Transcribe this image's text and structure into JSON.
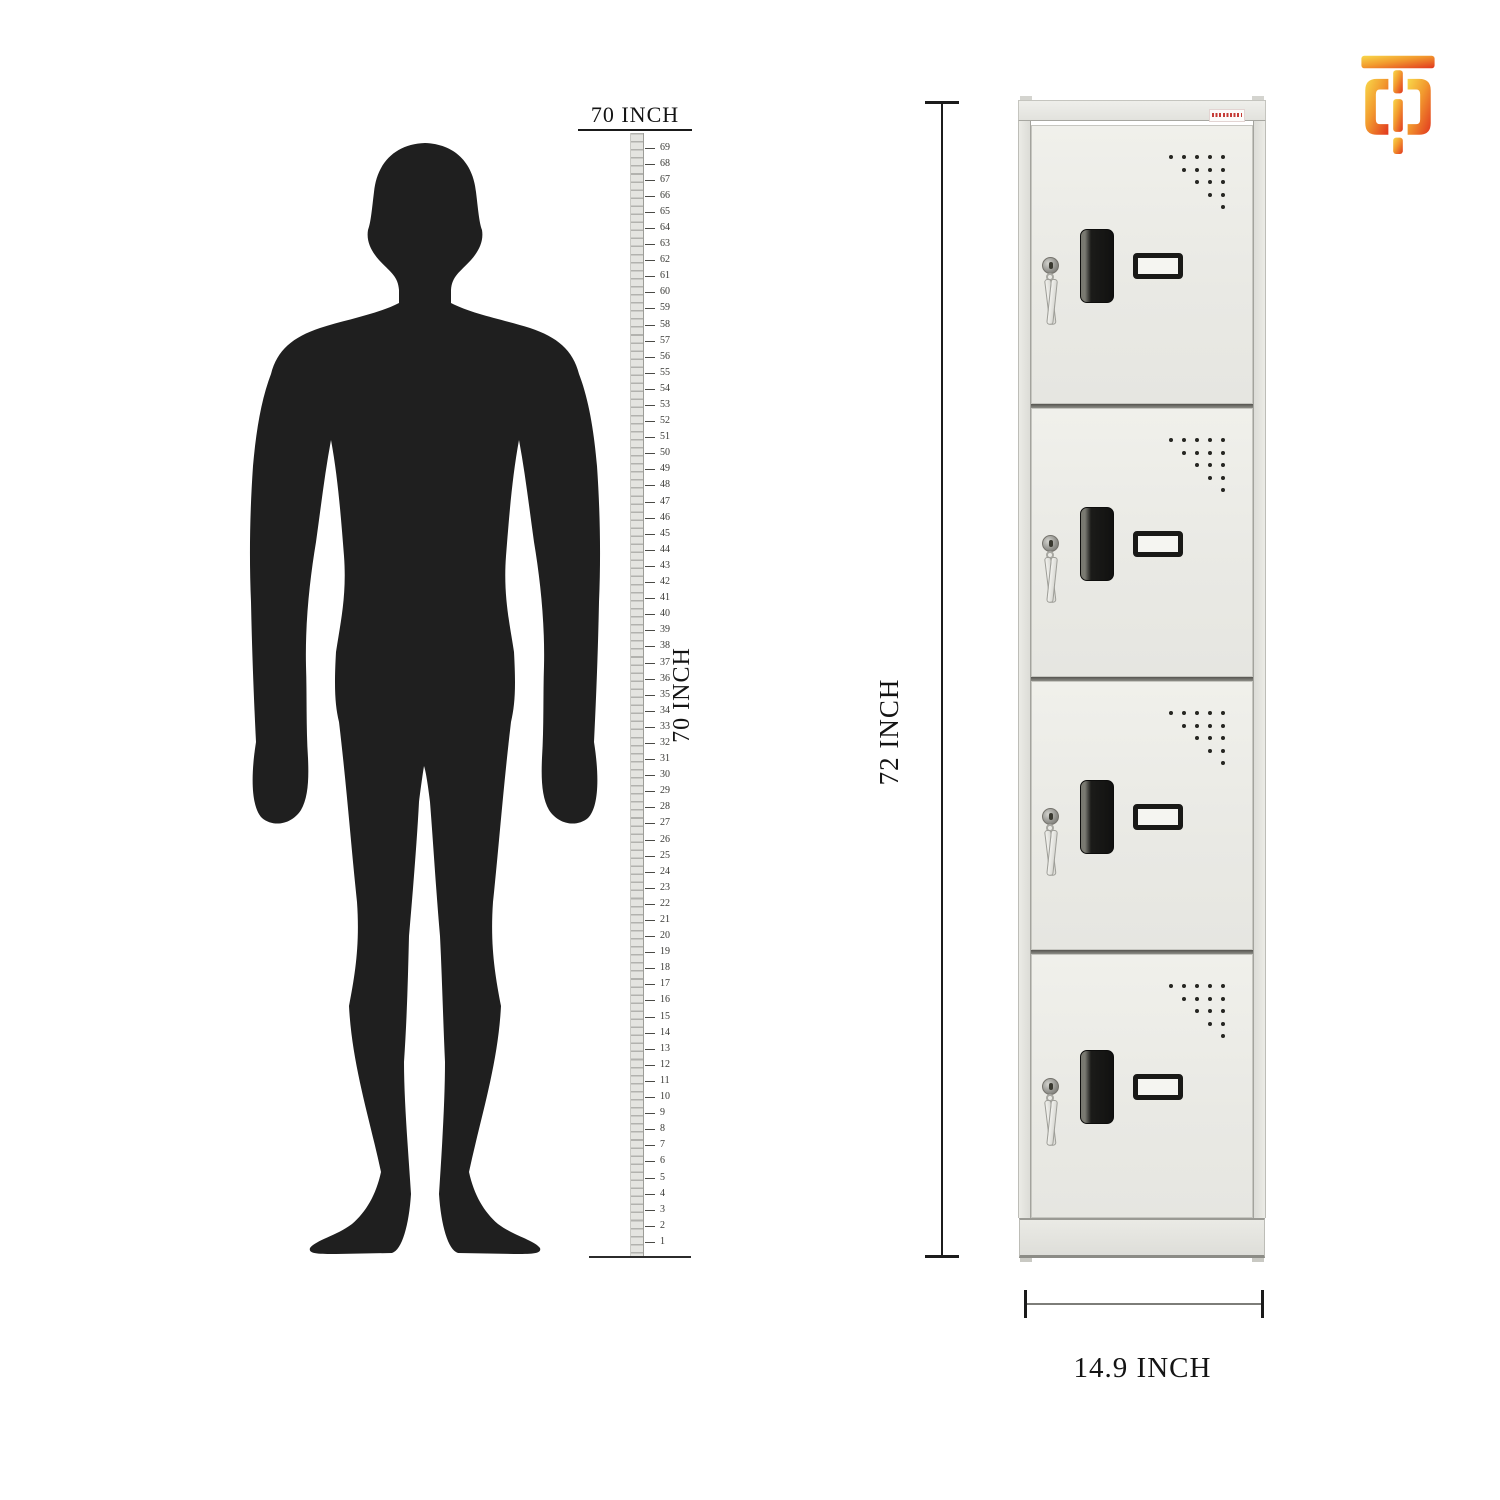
{
  "brand_logo": {
    "name": "orange TD monogram logo",
    "gradient_start": "#F8D84A",
    "gradient_mid": "#F29A2E",
    "gradient_end": "#E1371F"
  },
  "silhouette": {
    "description": "standing man silhouette",
    "color": "#1f1f1f"
  },
  "height_scale": {
    "top_label": "70 INCH",
    "side_label": "70 INCH",
    "tick_labels": [
      69,
      68,
      67,
      66,
      65,
      64,
      63,
      62,
      61,
      60,
      59,
      58,
      57,
      56,
      55,
      54,
      53,
      52,
      51,
      50,
      49,
      48,
      47,
      46,
      45,
      44,
      43,
      42,
      41,
      40,
      39,
      38,
      37,
      36,
      35,
      34,
      33,
      32,
      31,
      30,
      29,
      28,
      27,
      26,
      25,
      24,
      23,
      22,
      21,
      20,
      19,
      18,
      17,
      16,
      15,
      14,
      13,
      12,
      11,
      10,
      9,
      8,
      7,
      6,
      5,
      4,
      3,
      2,
      1
    ]
  },
  "locker": {
    "door_count": 4,
    "height_label": "72 INCH",
    "width_label": "14.9 INCH",
    "body_color": "#e8e8e3",
    "hardware_color": "#1b1b19",
    "sticker_text_color": "#c43b35",
    "vent_rows": 5,
    "vent_cols": 5
  }
}
